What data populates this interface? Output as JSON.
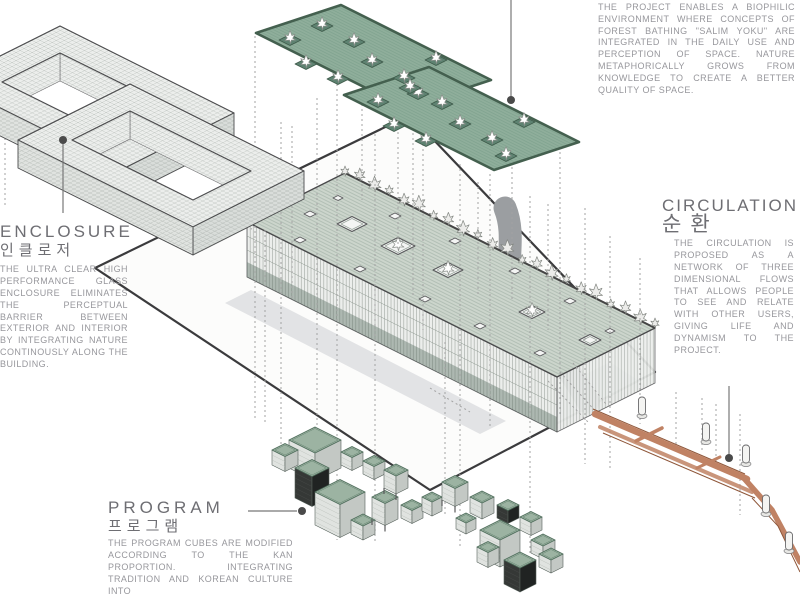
{
  "sections": {
    "biophilic": {
      "body": "THE PROJECT ENABLES A BIOPHILIC ENVIRONMENT WHERE CONCEPTS OF FOREST BATHING \"SALIM YOKU\" ARE INTEGRATED IN THE DAILY USE AND PERCEPTION OF SPACE. NATURE METAPHORICALLY GROWS FROM KNOWLEDGE TO CREATE A BETTER QUALITY OF SPACE."
    },
    "enclosure": {
      "title": "ENCLOSURE",
      "title_ko": "인클로저",
      "body": "THE ULTRA CLEAR HIGH PERFORMANCE GLASS ENCLOSURE ELIMINATES THE PERCEPTUAL BARRIER BETWEEN EXTERIOR AND INTERIOR BY INTEGRATING NATURE CONTINOUSLY ALONG THE BUILDING."
    },
    "circulation": {
      "title": "CIRCULATION",
      "title_ko": "순환",
      "body": "THE CIRCULATION IS PROPOSED AS A NETWORK OF THREE DIMENSIONAL FLOWS THAT ALLOWS PEOPLE TO SEE AND RELATE WITH OTHER USERS, GIVING LIFE AND DYNAMISM TO THE PROJECT."
    },
    "program": {
      "title": "PROGRAM",
      "title_ko": "프로그램",
      "body": "THE PROGRAM CUBES ARE MODIFIED ACCORDING TO THE KAN PROPORTION. INTEGRATING TRADITION AND KOREAN CULTURE INTO"
    }
  },
  "palette": {
    "glass": "#eceeec",
    "glassline": "#99a09a",
    "roof": "#ccd5cc",
    "roofline": "#a7b6ab",
    "green": "#8fae9b",
    "greenline": "#7ba08c",
    "greenedge": "#44604f",
    "planter": "#5e8271",
    "ink": "#4c4c4e",
    "siteline": "#3b3b3d",
    "site": "#fcfcfb",
    "road": "#9b9ea1",
    "plaza": "#d9dbdd",
    "copper": "#c08264",
    "copperdark": "#8e5639",
    "cubetop": "#9cb3a2",
    "cubetopline": "#4f6e5c",
    "cubeL": "#e0e3e0",
    "cubeR": "#c3c8c4",
    "cubedarkL": "#353836",
    "cubedarkR": "#202322",
    "text": "#97979c",
    "heading": "#6e6e73",
    "leader": "#777777",
    "dash": "#a3a3a3",
    "treefill": "#ffffff",
    "treeline": "#8b908b"
  }
}
